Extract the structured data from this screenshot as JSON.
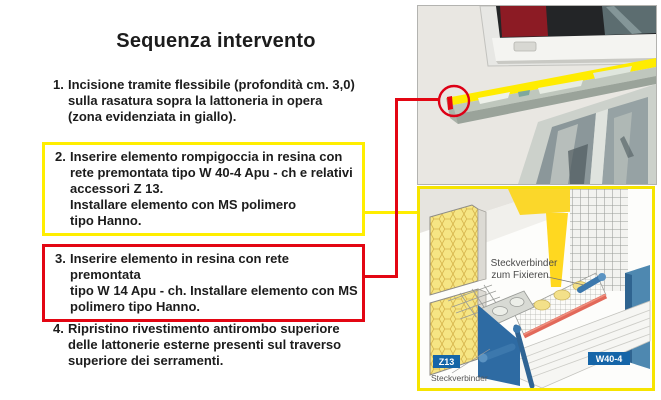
{
  "title": "Sequenza intervento",
  "steps": [
    {
      "num": "1.",
      "lines": [
        "Incisione tramite flessibile (profondità cm. 3,0)",
        "sulla rasatura sopra la lattoneria in opera",
        "(zona evidenziata in giallo)."
      ]
    },
    {
      "num": "2.",
      "lines": [
        "Inserire elemento rompigoccia  in resina con",
        "rete premontata tipo W 40-4 Apu - ch e relativi",
        "accessori Z 13.",
        "Installare elemento con MS polimero",
        "tipo Hanno."
      ]
    },
    {
      "num": "3.",
      "lines": [
        "Inserire elemento in resina con rete premontata",
        "tipo W 14 Apu - ch. Installare elemento con MS",
        "polimero tipo Hanno."
      ]
    },
    {
      "num": "4.",
      "lines": [
        "Ripristino rivestimento antirombo superiore",
        "delle lattonerie esterne presenti sul traverso",
        "superiore dei serramenti."
      ]
    }
  ],
  "diagram": {
    "callout_line1": "Steckverbinder",
    "callout_line2": "zum Fixieren",
    "badge_z13": "Z13",
    "label_steckverbinder": "Steckverbinder",
    "badge_w404": "W40-4"
  },
  "colors": {
    "highlight_yellow": "#ffee00",
    "alert_red": "#e30613",
    "badge_blue": "#1565a8",
    "drip_profile_red": "#e2695a"
  }
}
